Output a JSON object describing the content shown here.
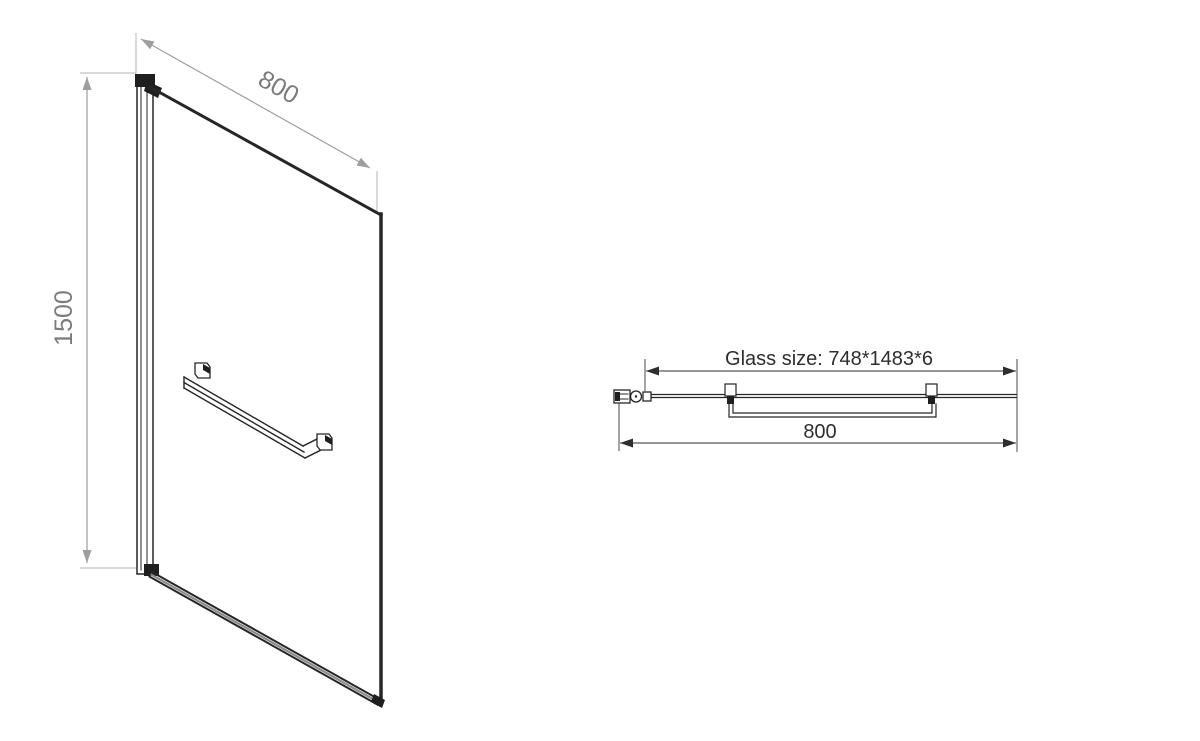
{
  "drawing": {
    "description": "Shower glass panel technical drawing, front isometric view and plan (top) view",
    "background_color": "#ffffff",
    "line_color": "#262626",
    "dimension_line_color_front": "#9e9e9e",
    "dimension_line_color_top": "#2e2e2e",
    "dimension_text_color_front": "#7b7b7b",
    "dimension_text_color_top": "#2e2e2e",
    "front_view": {
      "width_dimension_label": "800",
      "height_dimension_label": "1500"
    },
    "top_view": {
      "glass_size_label": "Glass size: 748*1483*6",
      "width_dimension_label": "800"
    }
  }
}
